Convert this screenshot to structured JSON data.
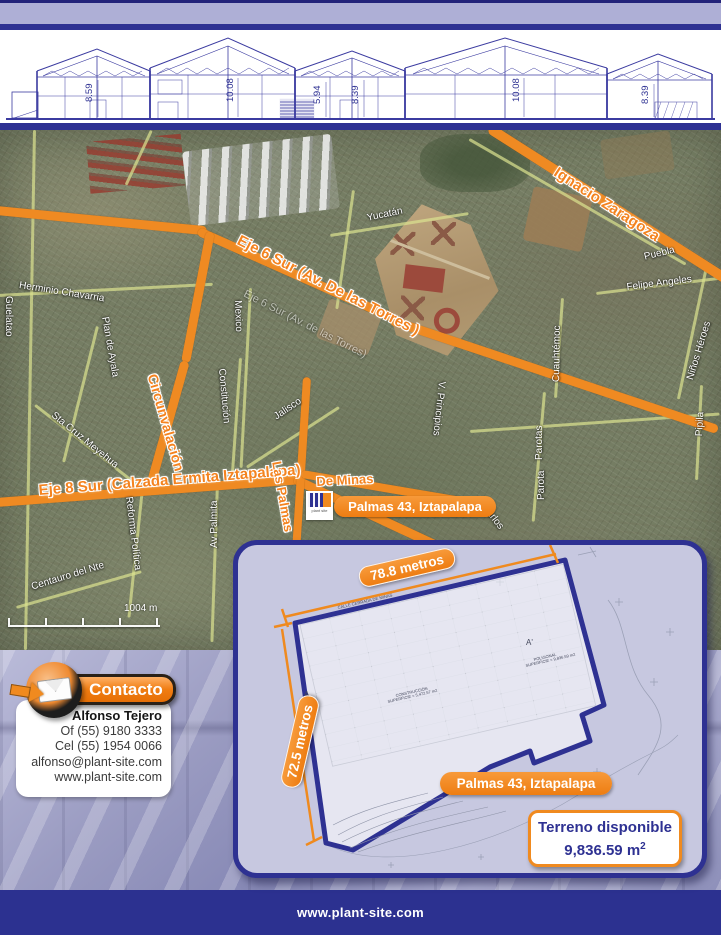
{
  "header": {
    "arch_dimensions": [
      "8.59",
      "10.08",
      "5.94",
      "8.39",
      "10.08",
      "8.39"
    ]
  },
  "map": {
    "road_labels": {
      "eje6": "Eje 6 Sur (Av. De las Torres )",
      "eje6_faint": "Eje 6 Sur (Av. de las Torres)",
      "zaragoza": "Ignacio Zaragoza",
      "circunvalacion": "Circunvalación",
      "eje8": "Eje 8 Sur (Calzada Ermita Iztapalapa)",
      "las_palmas": "Las Palmas",
      "de_minas": "De Minas"
    },
    "street_labels": {
      "guelatao": "Guelatao",
      "herminio": "Herminio Chavarria",
      "plan_ayala": "Plan de Ayala",
      "sta_cruz": "Sta Cruz Meyehua",
      "mexico": "Mexico",
      "constitucion": "Constitución",
      "jalisco": "Jalisco",
      "yucatan": "Yucatán",
      "puebla": "Puebla",
      "felipe": "Felipe Angeles",
      "cuauhtemoc": "Cuauhtémoc",
      "ninos": "Niños Héroes",
      "principios": "V. Principios",
      "parotas": "Parotas",
      "parota": "Parota",
      "pipila": "Pipila",
      "carlos": "Carlos",
      "centauro": "Centauro del Nte",
      "reforma": "Reforma Política",
      "av_palmita": "Av Palmita"
    },
    "scale_label": "1004 m",
    "location_badge": "Palmas 43, Iztapalapa",
    "logo_text": "plant site"
  },
  "inset": {
    "dim_top": "78.8 metros",
    "dim_left": "72.5 metros",
    "plan_street": "CALLE CERRADA DE MINAS",
    "marker_a": "A",
    "marker_a2": "A'",
    "note_poligonal_1": "POLIGONAL",
    "note_poligonal_2": "SUPERFICIE = 9,836.59 m2",
    "note_construccion_1": "CONSTRUCCIÓN",
    "note_construccion_2": "SUPERFICIE = 5,472.57 m2",
    "location_badge": "Palmas 43, Iztapalapa",
    "terreno_title": "Terreno disponible",
    "terreno_value": "9,836.59 m",
    "terreno_sup": "2"
  },
  "contact": {
    "title": "Contacto",
    "name": "Alfonso Tejero",
    "office": "Of (55) 9180 3333",
    "cell": "Cel (55) 1954 0066",
    "email": "alfonso@plant-site.com",
    "web": "www.plant-site.com"
  },
  "footer": {
    "url": "www.plant-site.com"
  },
  "colors": {
    "brand_blue": "#2e3192",
    "brand_orange": "#f08a1f",
    "lavender": "#aeafd6",
    "panel_lavender": "#c7c8e0"
  }
}
